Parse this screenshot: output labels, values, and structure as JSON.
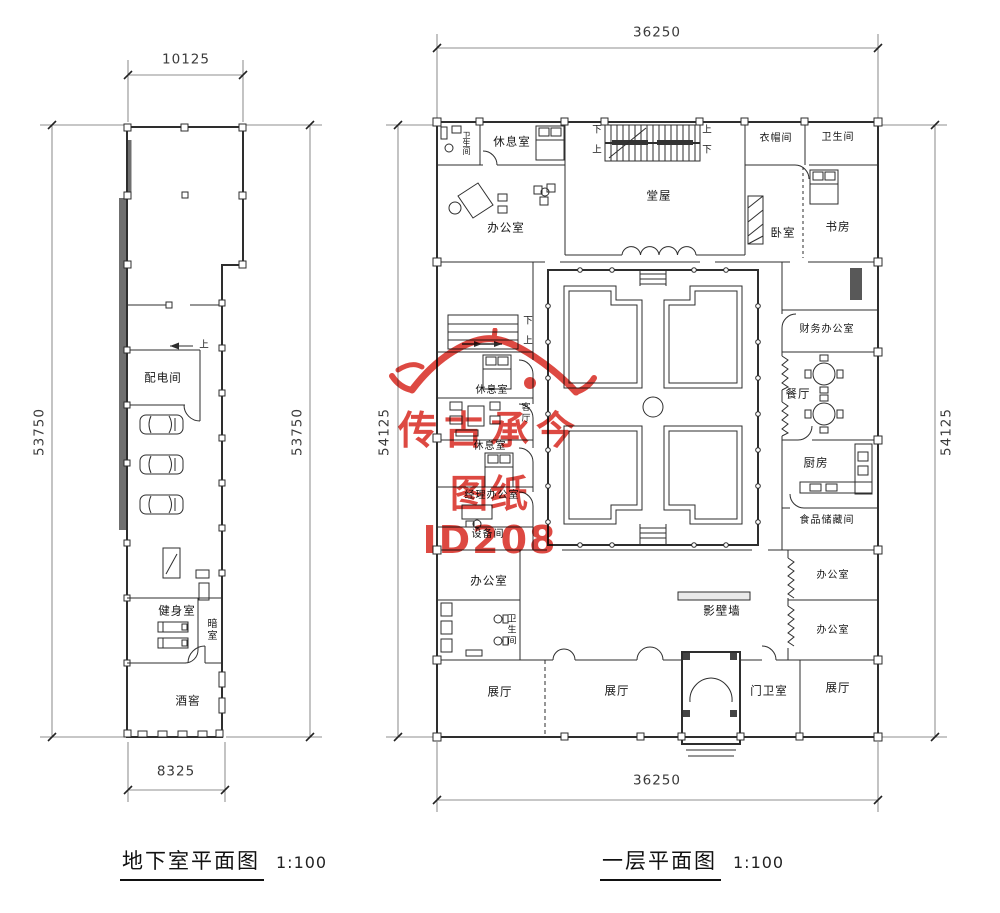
{
  "watermark": {
    "line1": "传古承今",
    "line2": "图纸 ID208",
    "color": "#d92f27"
  },
  "basement": {
    "title": "地下室平面图",
    "scale": "1:100",
    "dims": {
      "top": "10125",
      "bottom": "8325",
      "left": "53750",
      "right": "53750"
    },
    "labels": {
      "power_room": "配电间",
      "gym": "健身室",
      "darkroom": "暗室",
      "wine_cellar": "酒窖",
      "up": "上"
    }
  },
  "first_floor": {
    "title": "一层平面图",
    "scale": "1:100",
    "dims": {
      "top": "36250",
      "bottom": "36250",
      "left": "54125",
      "right": "54125"
    },
    "labels": {
      "bath_top_left": "卫生间",
      "lounge_top": "休息室",
      "main_hall": "堂屋",
      "cloakroom": "衣帽间",
      "bath_top_right": "卫生间",
      "office_top_left": "办公室",
      "bedroom": "卧室",
      "study": "书房",
      "finance_office": "财务办公室",
      "dining_room": "餐厅",
      "kitchen": "厨房",
      "pantry": "食品储藏间",
      "lounge_mid_1": "休息室",
      "living_room": "客厅",
      "lounge_mid_2": "休息室",
      "manager_office": "经理办公室",
      "equipment_room": "设备间",
      "office_bottom_left": "办公室",
      "bath_bottom_left": "卫生间",
      "screen_wall": "影壁墙",
      "office_right_1": "办公室",
      "office_right_2": "办公室",
      "exhibit_left": "展厅",
      "exhibit_center": "展厅",
      "exhibit_right": "展厅",
      "guard_room": "门卫室",
      "up": "上",
      "down": "下"
    }
  }
}
